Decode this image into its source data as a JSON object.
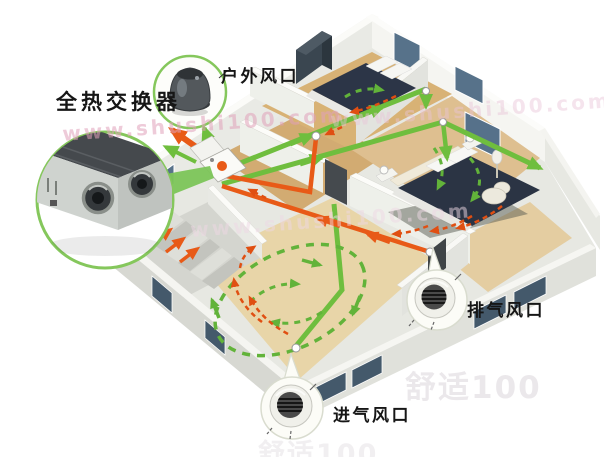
{
  "labels": {
    "heat_exchanger": "全热交换器",
    "outdoor_vent": "户外风口",
    "exhaust_vent": "排气风口",
    "intake_vent": "进气风口"
  },
  "watermarks": {
    "url": "www.shushi100.com",
    "brand": "舒适100"
  },
  "colors": {
    "supply_air_green": "#6fbe3e",
    "exhaust_air_orange": "#e85a17",
    "callout_ring_green": "#85c75c",
    "floor_wood": "#ddbf92",
    "wall_white": "#f1f2ee",
    "bed_navy": "#2c3547",
    "window_blue": "#44596b",
    "label_text": "#161616"
  }
}
